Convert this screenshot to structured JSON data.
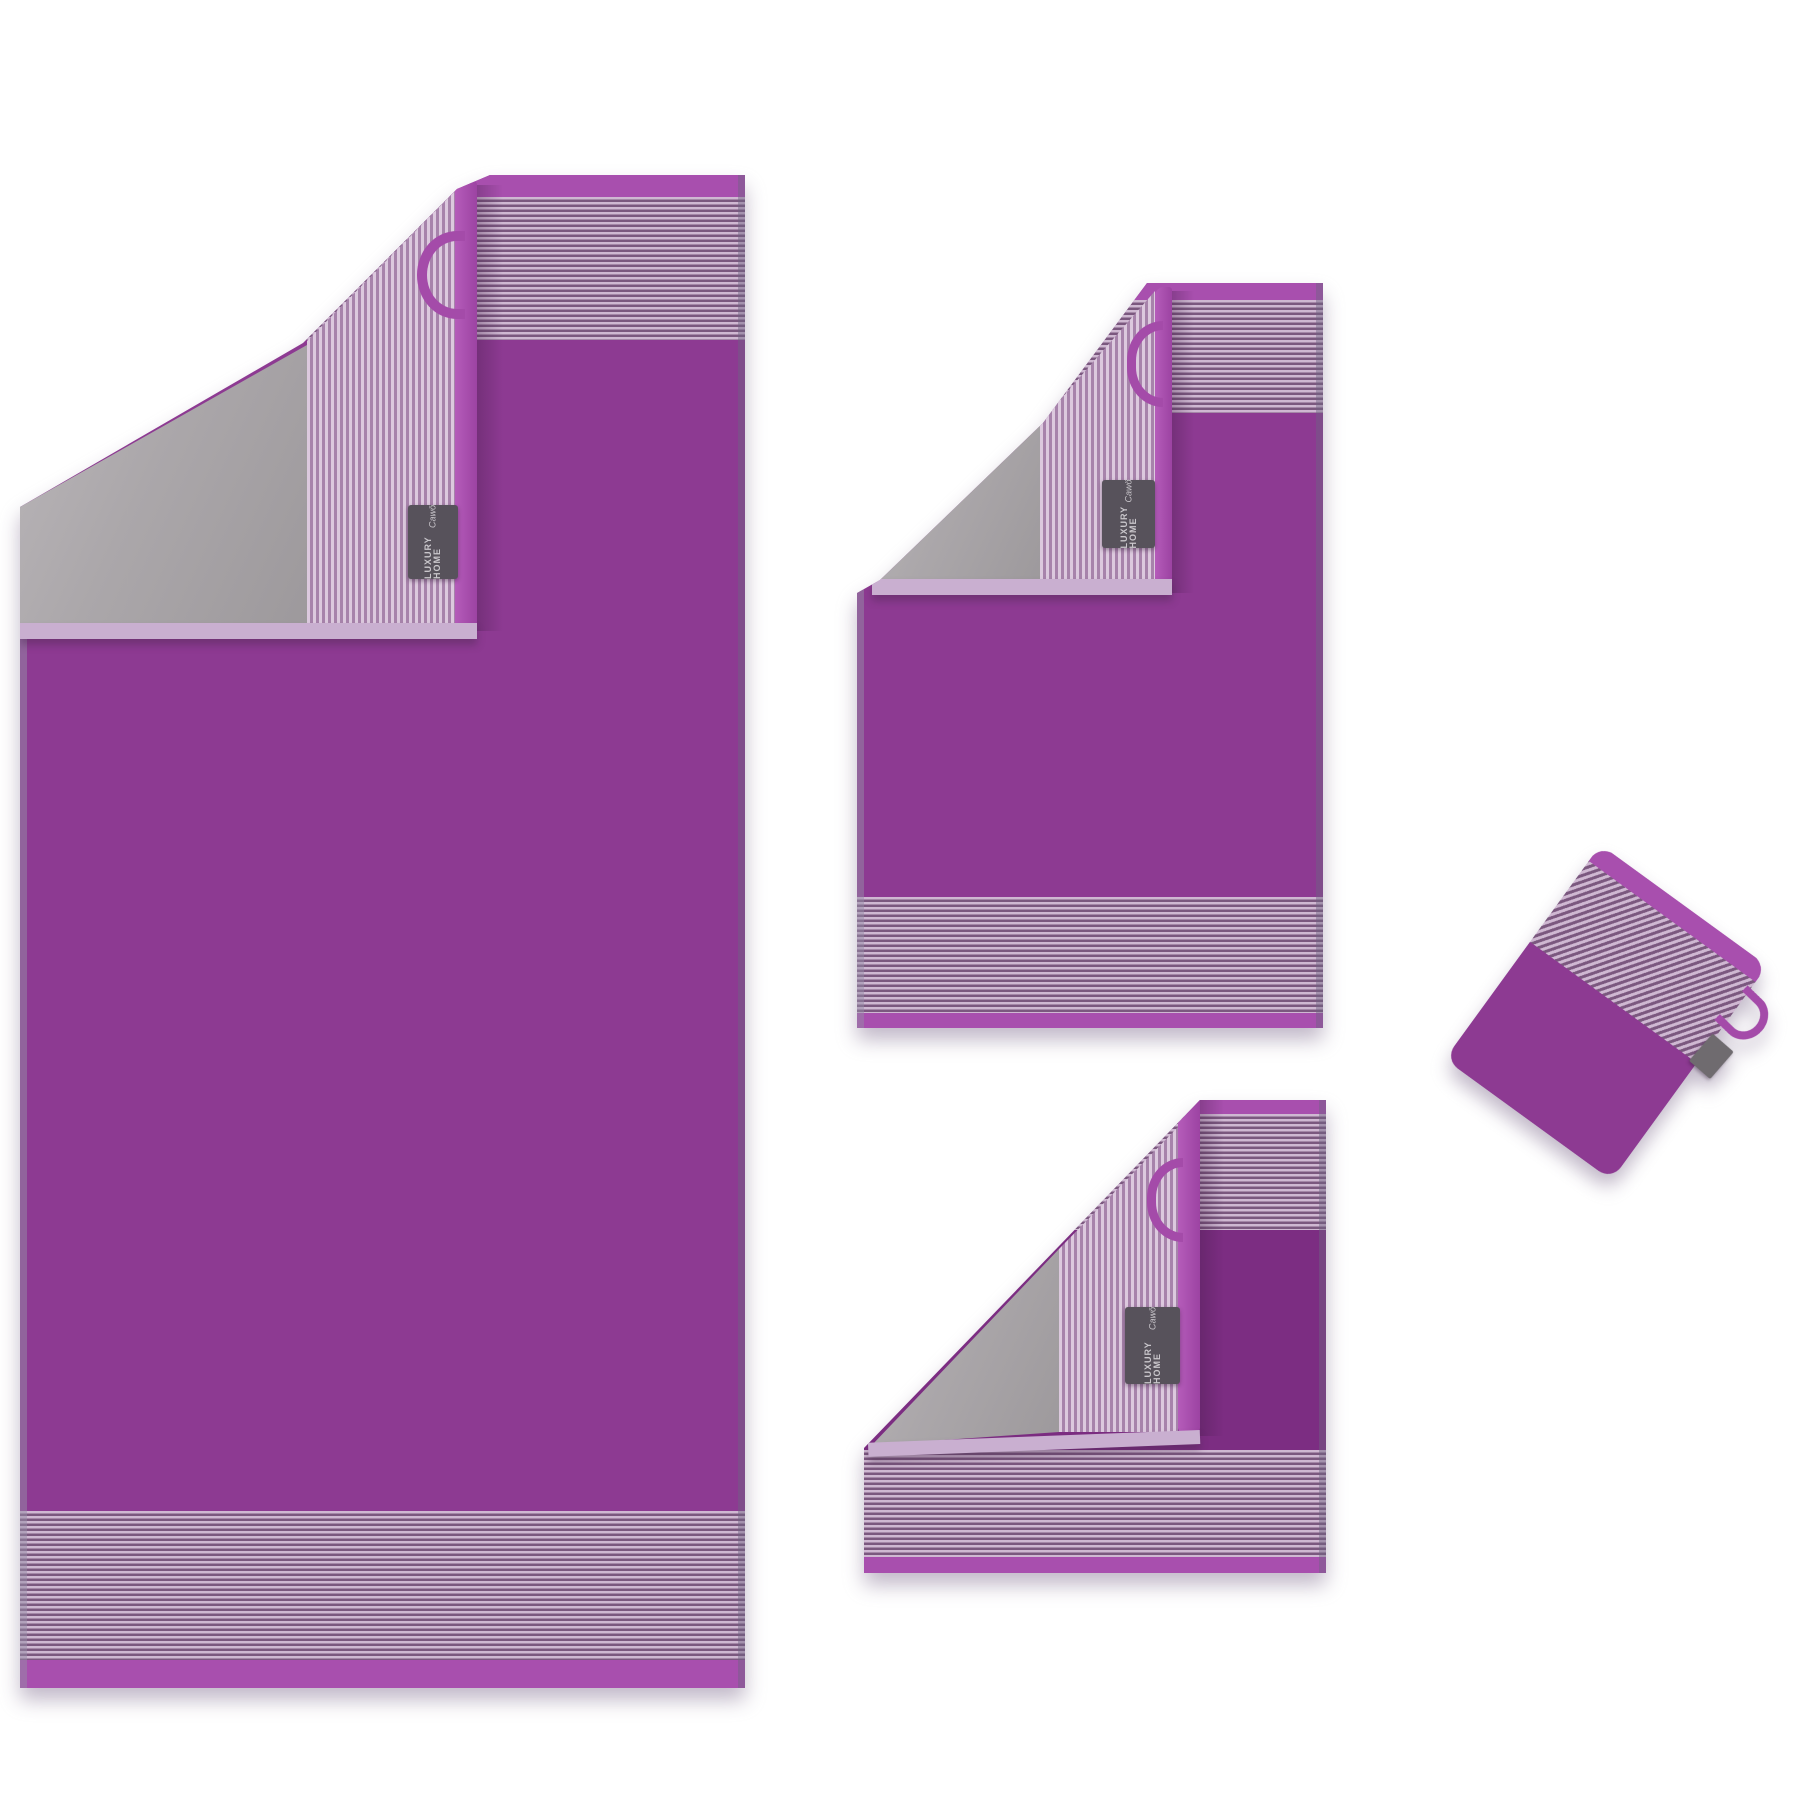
{
  "scene": {
    "type": "product-photo",
    "background_color": "#ffffff",
    "description": "Purple two-tone terry towel set with striped borders and grey reverse side: bath towel, hand towel and guest towel each shown with a corner folded back revealing the grey back, vertical striped inner border, purple hanging loop and woven brand label; plus a tilted wash mitt at the right."
  },
  "brand_label": {
    "collection": "LUXURY HOME",
    "brand": "Cawö",
    "background": "#57525b",
    "text_color": "#c9c6cb"
  },
  "colors": {
    "towel_purple": "#8d3a92",
    "guest_towel_purple": "#7c2d82",
    "binding_purple": "#a84fae",
    "stripe_light": "#cfb8d2",
    "stripe_dark": "#7b587f",
    "reverse_stripe_light": "#dcc9de",
    "reverse_stripe_dark": "#a783ab",
    "reverse_grey": "#a8a4a7",
    "flap_hem": "#c9afd0",
    "mitt_tag_grey": "#6f6b6f"
  },
  "items": [
    {
      "id": "bath-towel",
      "name": "Bath towel"
    },
    {
      "id": "hand-towel",
      "name": "Hand towel"
    },
    {
      "id": "guest-towel",
      "name": "Guest towel"
    },
    {
      "id": "wash-mitt",
      "name": "Wash mitt"
    }
  ]
}
